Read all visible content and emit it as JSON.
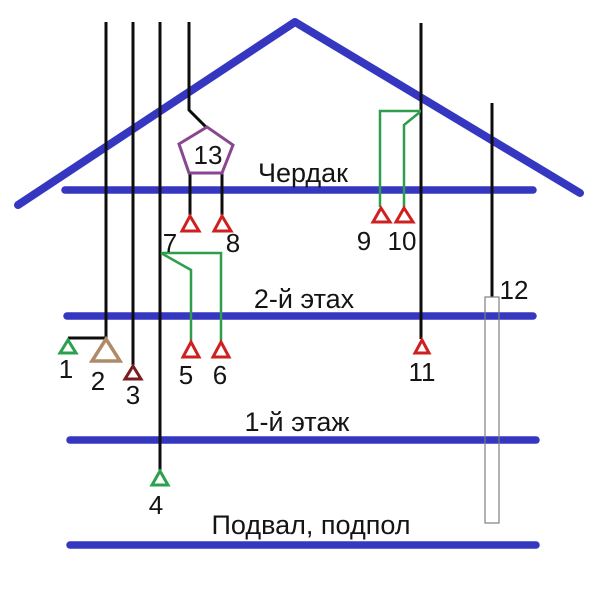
{
  "diagram": {
    "description": "House cross-section wiring/sensor placement scheme",
    "floor_labels": [
      {
        "id": "attic",
        "label": "Чердак"
      },
      {
        "id": "second-floor",
        "label": "2-й этах"
      },
      {
        "id": "first-floor",
        "label": "1-й этаж"
      },
      {
        "id": "basement",
        "label": "Подвал, подпол"
      }
    ],
    "point_labels": {
      "p1": "1",
      "p2": "2",
      "p3": "3",
      "p4": "4",
      "p5": "5",
      "p6": "6",
      "p7": "7",
      "p8": "8",
      "p9": "9",
      "p10": "10",
      "p11": "11",
      "p12": "12",
      "p13": "13"
    },
    "colors": {
      "structure": "#3537c1",
      "cable": "#0d0d0d",
      "wire_green": "#2e9e4a",
      "marker_red": "#cf2020",
      "marker_dark_red": "#7a1d22",
      "marker_green": "#2aa14e",
      "marker_tan": "#ae8a68",
      "pentagon": "#8b4691",
      "duct_outline": "#7f7f7f"
    }
  }
}
